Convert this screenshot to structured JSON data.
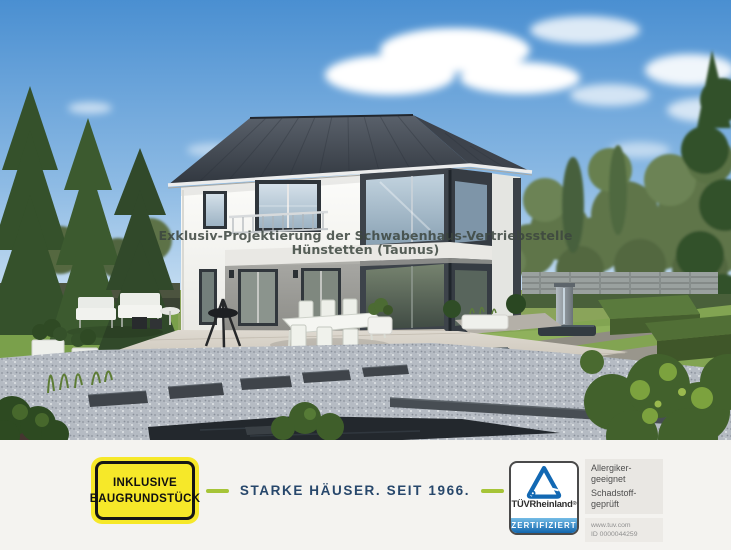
{
  "watermark": {
    "line1": "Exklusiv-Projektierung der Schwabenhaus-Vertriebsstelle",
    "line2": "Hünstetten (Taunus)"
  },
  "banner": {
    "badge": {
      "line1": "INKLUSIVE",
      "line2": "BAUGRUNDSTÜCK"
    },
    "slogan": "STARKE HÄUSER. SEIT 1966.",
    "tuv": {
      "brand_bold": "TÜV",
      "brand_rest": "Rheinland",
      "registered": "®",
      "certified_label": "ZERTIFIZIERT",
      "cert_lines": [
        "Allergiker-",
        "geeignet",
        "Schadstoff-",
        "geprüft"
      ],
      "url": "www.tuv.com",
      "id": "ID 0000044259"
    }
  },
  "icons": {
    "tuv_triangle": "tuv-rheinland-triangle-icon"
  },
  "colors": {
    "badge_yellow": "#f6e829",
    "slogan_navy": "#27476b",
    "dash_green": "#a6c437",
    "tuv_blue": "#1166ad"
  }
}
